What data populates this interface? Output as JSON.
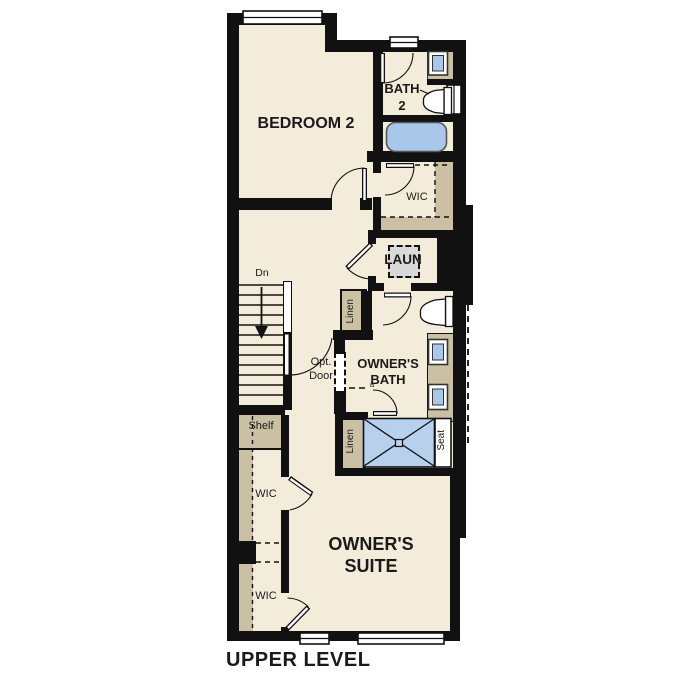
{
  "title": "UPPER LEVEL",
  "colors": {
    "wall": "#111111",
    "floor": "#f4ecdb",
    "casework": "#cbbfa4",
    "fixture_blue": "#a9c8e9",
    "shower_blue": "#b7d0ec",
    "appliance_gray": "#d9d9d9",
    "text": "#1a1a1a"
  },
  "rooms": {
    "bedroom2": "BEDROOM 2",
    "bath2_line1": "BATH",
    "bath2_line2": "2",
    "wic_upper": "WIC",
    "laundry": "LAUN",
    "owners_bath_line1": "OWNER'S",
    "owners_bath_line2": "BATH",
    "owners_suite_line1": "OWNER'S",
    "owners_suite_line2": "SUITE"
  },
  "labels": {
    "stairs_direction": "Dn",
    "hall_linen": "Linen",
    "shower_linen": "Linen",
    "shower_seat": "Seat",
    "shelf": "Shelf",
    "wic_closet_1": "WIC",
    "wic_closet_2": "WIC",
    "optional_door_line1": "Opt.",
    "optional_door_line2": "Door",
    "marker": "a"
  }
}
